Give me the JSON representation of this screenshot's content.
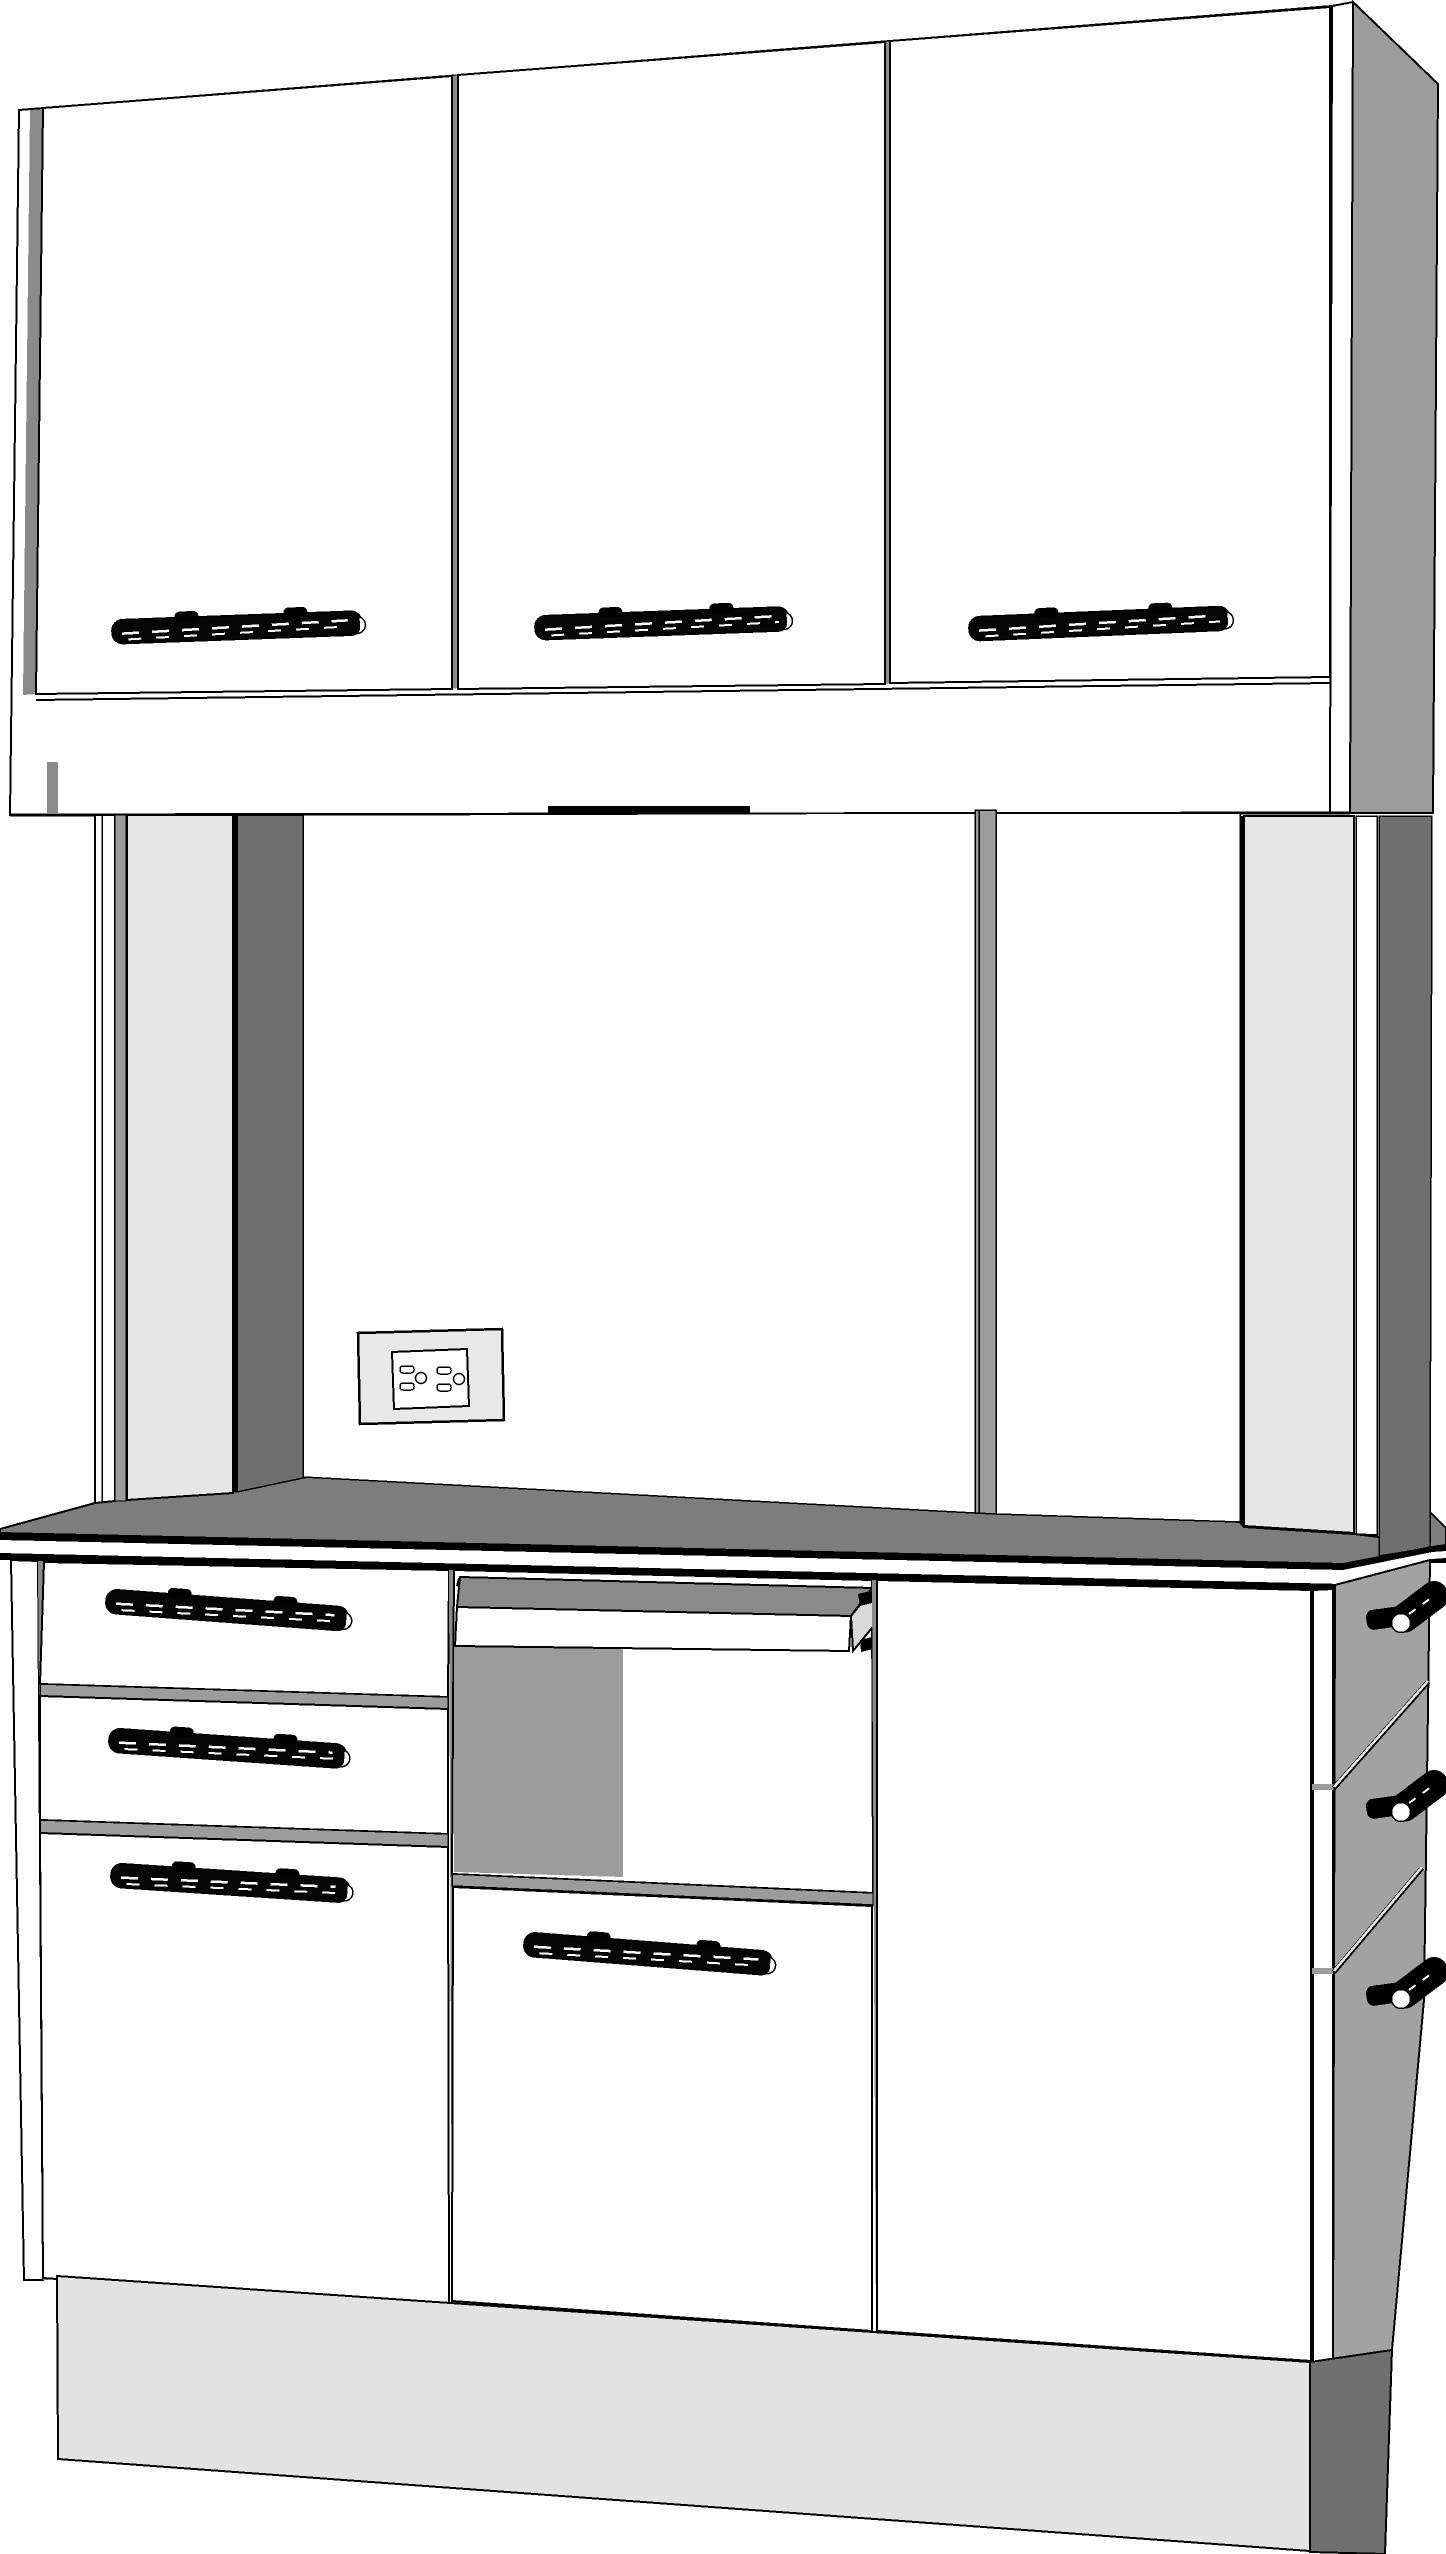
{
  "drawing": {
    "kind": "3D perspective line rendering of a white hutch cabinet with countertop, upper doors, drawers, pull-out tray and electrical outlet",
    "background": "#ffffff",
    "outline": "#000000"
  },
  "colors": {
    "outline": "#000000",
    "white": "#ffffff",
    "counter_top": "#7d7d7d",
    "tray_top": "#8a8a8a",
    "tray_end": "#d9d9d9",
    "side_panel": "#9c9c9c",
    "divider": "#9c9c9c",
    "shadow_dark": "#6f6f6f",
    "pillar_front": "#e6e6e6",
    "pillar_sliver": "#9c9c9c",
    "outlet_plate": "#e8e8e8",
    "base_front": "#e2e2e2",
    "base_side": "#6f6f6f",
    "knob_panel": "#a2a2a2",
    "bay_shadow": "#9c9c9c",
    "gap": "#8a8a8a",
    "handle": "#050505",
    "handle_cap": "#ffffff"
  },
  "components": {
    "upper_cabinet": {
      "label": "wall cabinet",
      "door_count": 3,
      "handle_count": 3
    },
    "hutch": {
      "label": "open hutch back",
      "pillar_count": 2,
      "back_panel_count": 3,
      "outlet": {
        "receptacle_count": 2,
        "slot_count": 4
      }
    },
    "countertop": {
      "label": "countertop slab"
    },
    "base_cabinet": {
      "left_drawers": {
        "drawer_count": 3,
        "handle_count": 3
      },
      "center": {
        "tray": "pull-out tray",
        "door_count": 1,
        "handle_count": 1
      },
      "right": {
        "door_count": 1
      },
      "side_drawers": {
        "knob_count": 3,
        "gap_line_count": 2
      }
    },
    "base": {
      "label": "toe-kick base"
    }
  }
}
